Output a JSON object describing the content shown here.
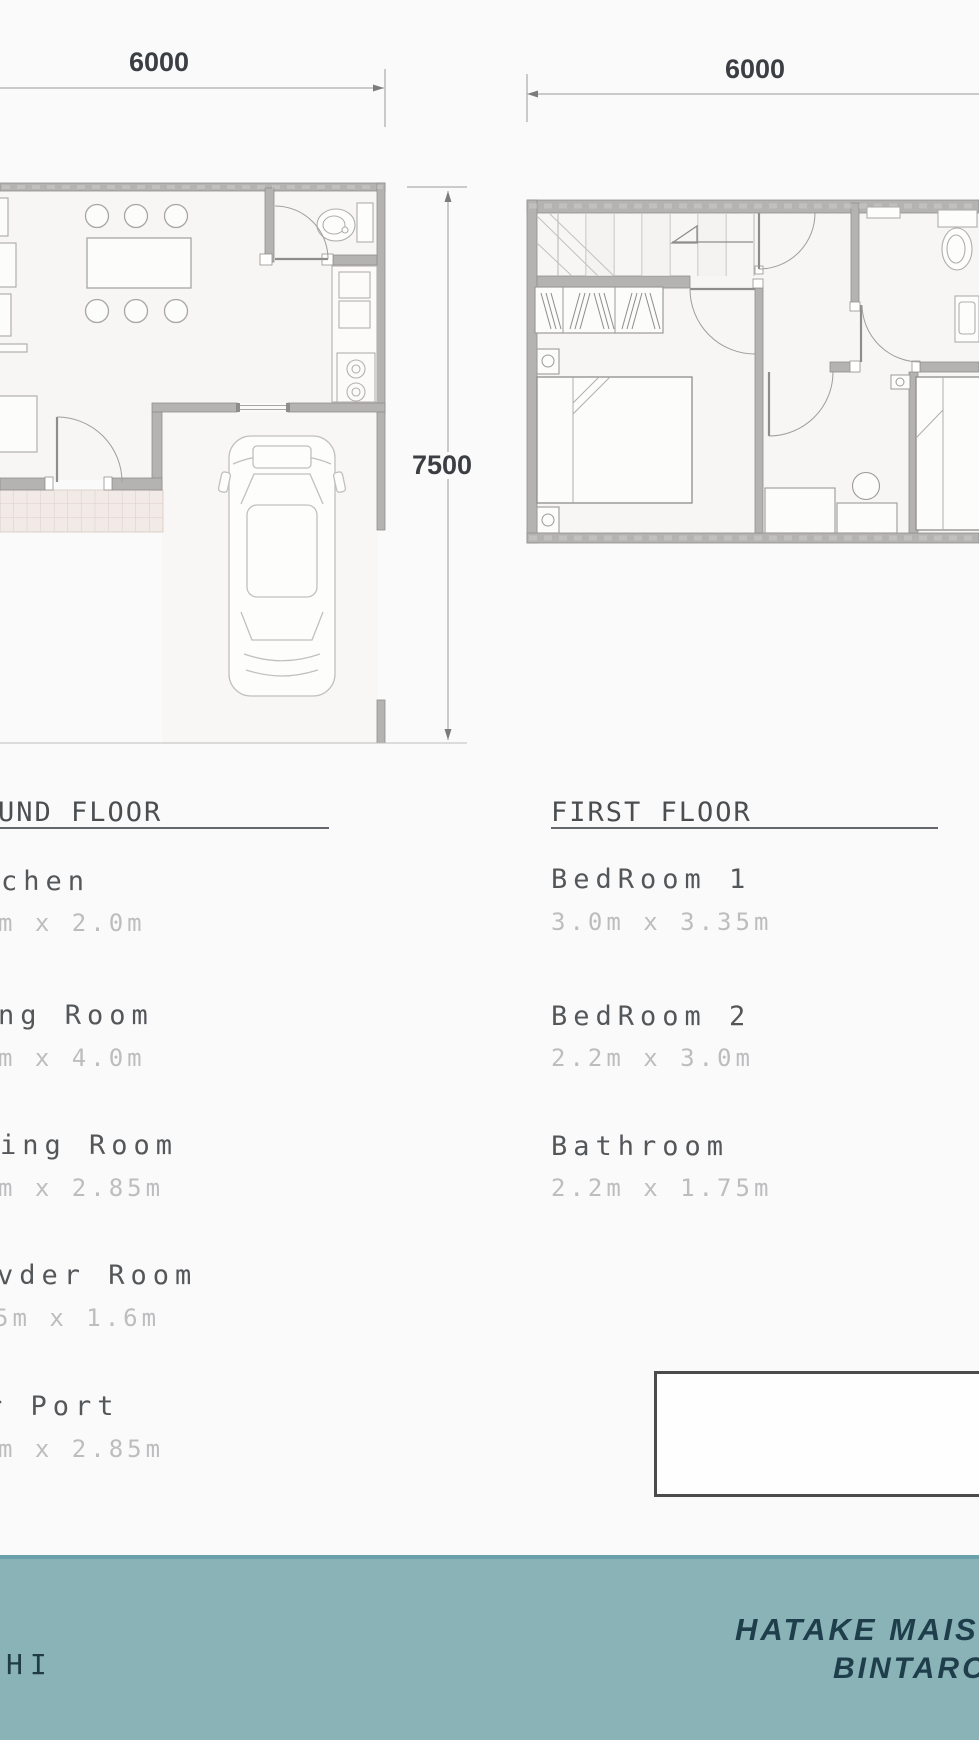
{
  "dimensions": {
    "ground_width_label": "6000",
    "first_width_label": "6000",
    "ground_depth_label": "7500"
  },
  "ground_floor": {
    "heading_visible": "UND FLOOR",
    "rooms": [
      {
        "label": "chen",
        "size": "m x 2.0m"
      },
      {
        "label": "ng Room",
        "size": "m x 4.0m"
      },
      {
        "label": "ing Room",
        "size": "m x 2.85m"
      },
      {
        "label": "vder Room",
        "size": "5m x 1.6m"
      },
      {
        "label": "r Port",
        "size": "m x 2.85m"
      }
    ]
  },
  "first_floor": {
    "heading": "FIRST FLOOR",
    "rooms": [
      {
        "label": "BedRoom 1",
        "size": "3.0m x 3.35m"
      },
      {
        "label": "BedRoom 2",
        "size": "2.2m x 3.0m"
      },
      {
        "label": "Bathroom",
        "size": "2.2m x 1.75m"
      }
    ]
  },
  "footer": {
    "left_fragment": "HI",
    "brand_line1": "HATAKE MAISON",
    "brand_line2": "BINTARO"
  },
  "colors": {
    "footer_bg": "#8ab3b8",
    "footer_text": "#1f3e4b",
    "wall": "#b5b3b1",
    "dim_text": "#3b3e43",
    "room_label_text": "#54575a",
    "room_size_text": "#bcbdbf"
  }
}
